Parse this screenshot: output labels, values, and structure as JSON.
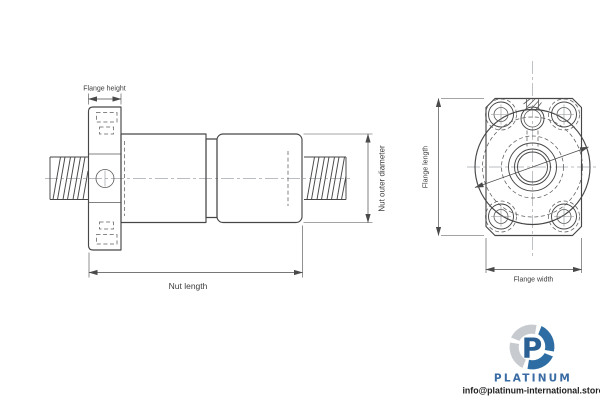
{
  "drawing": {
    "side_view": {
      "dims": {
        "flange_height": "Flange height",
        "nut_outer_diameter": "Nut outer diameter",
        "nut_length": "Nut length"
      }
    },
    "front_view": {
      "dims": {
        "flange_length": "Flange length",
        "flange_width": "Flange width"
      }
    },
    "colors": {
      "line": "#474747",
      "centerline": "#a3a8ad",
      "background": "#ffffff"
    }
  },
  "branding": {
    "logo_letter": "P",
    "logo_text": "PLATINUM",
    "email": "info@platinum-international.store",
    "colors": {
      "blue": "#2e6da4",
      "navy": "#2b6094",
      "text_blue": "#3a6ca3",
      "gray": "#c7cbd0"
    }
  }
}
